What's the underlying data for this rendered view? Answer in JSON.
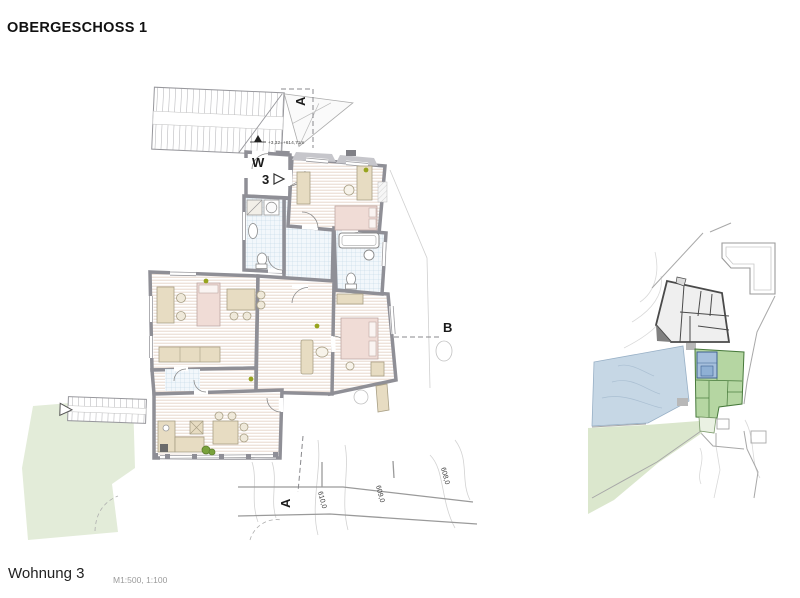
{
  "header": {
    "title": "OBERGESCHOSS 1"
  },
  "footer": {
    "apartment": "Wohnung 3",
    "scale": "M1:500, 1:100"
  },
  "floor_plan": {
    "apartment_marker": {
      "line1": "W",
      "line2": "3"
    },
    "elevation_label": "+3,32=+614,71m",
    "section_a_top": "A",
    "section_a_bottom": "A",
    "section_b": "B",
    "contour_labels": [
      "610,0",
      "609,0",
      "608,0"
    ]
  },
  "colors": {
    "wall_gray": "#8f8f96",
    "wood_stripe": "#e8d7cc",
    "tile_fill": "#f2f7fb",
    "tile_grid": "#bdd3e4",
    "furniture_tan": "#e7dcc2",
    "bed_pink": "#f0dcd6",
    "landscape_green": "#e3ecd9",
    "site_water_blue": "#c6d7e5",
    "site_building_green": "#b5d6a2",
    "site_green_outline": "#47793b",
    "accent_dot_olive": "#97a41e"
  }
}
